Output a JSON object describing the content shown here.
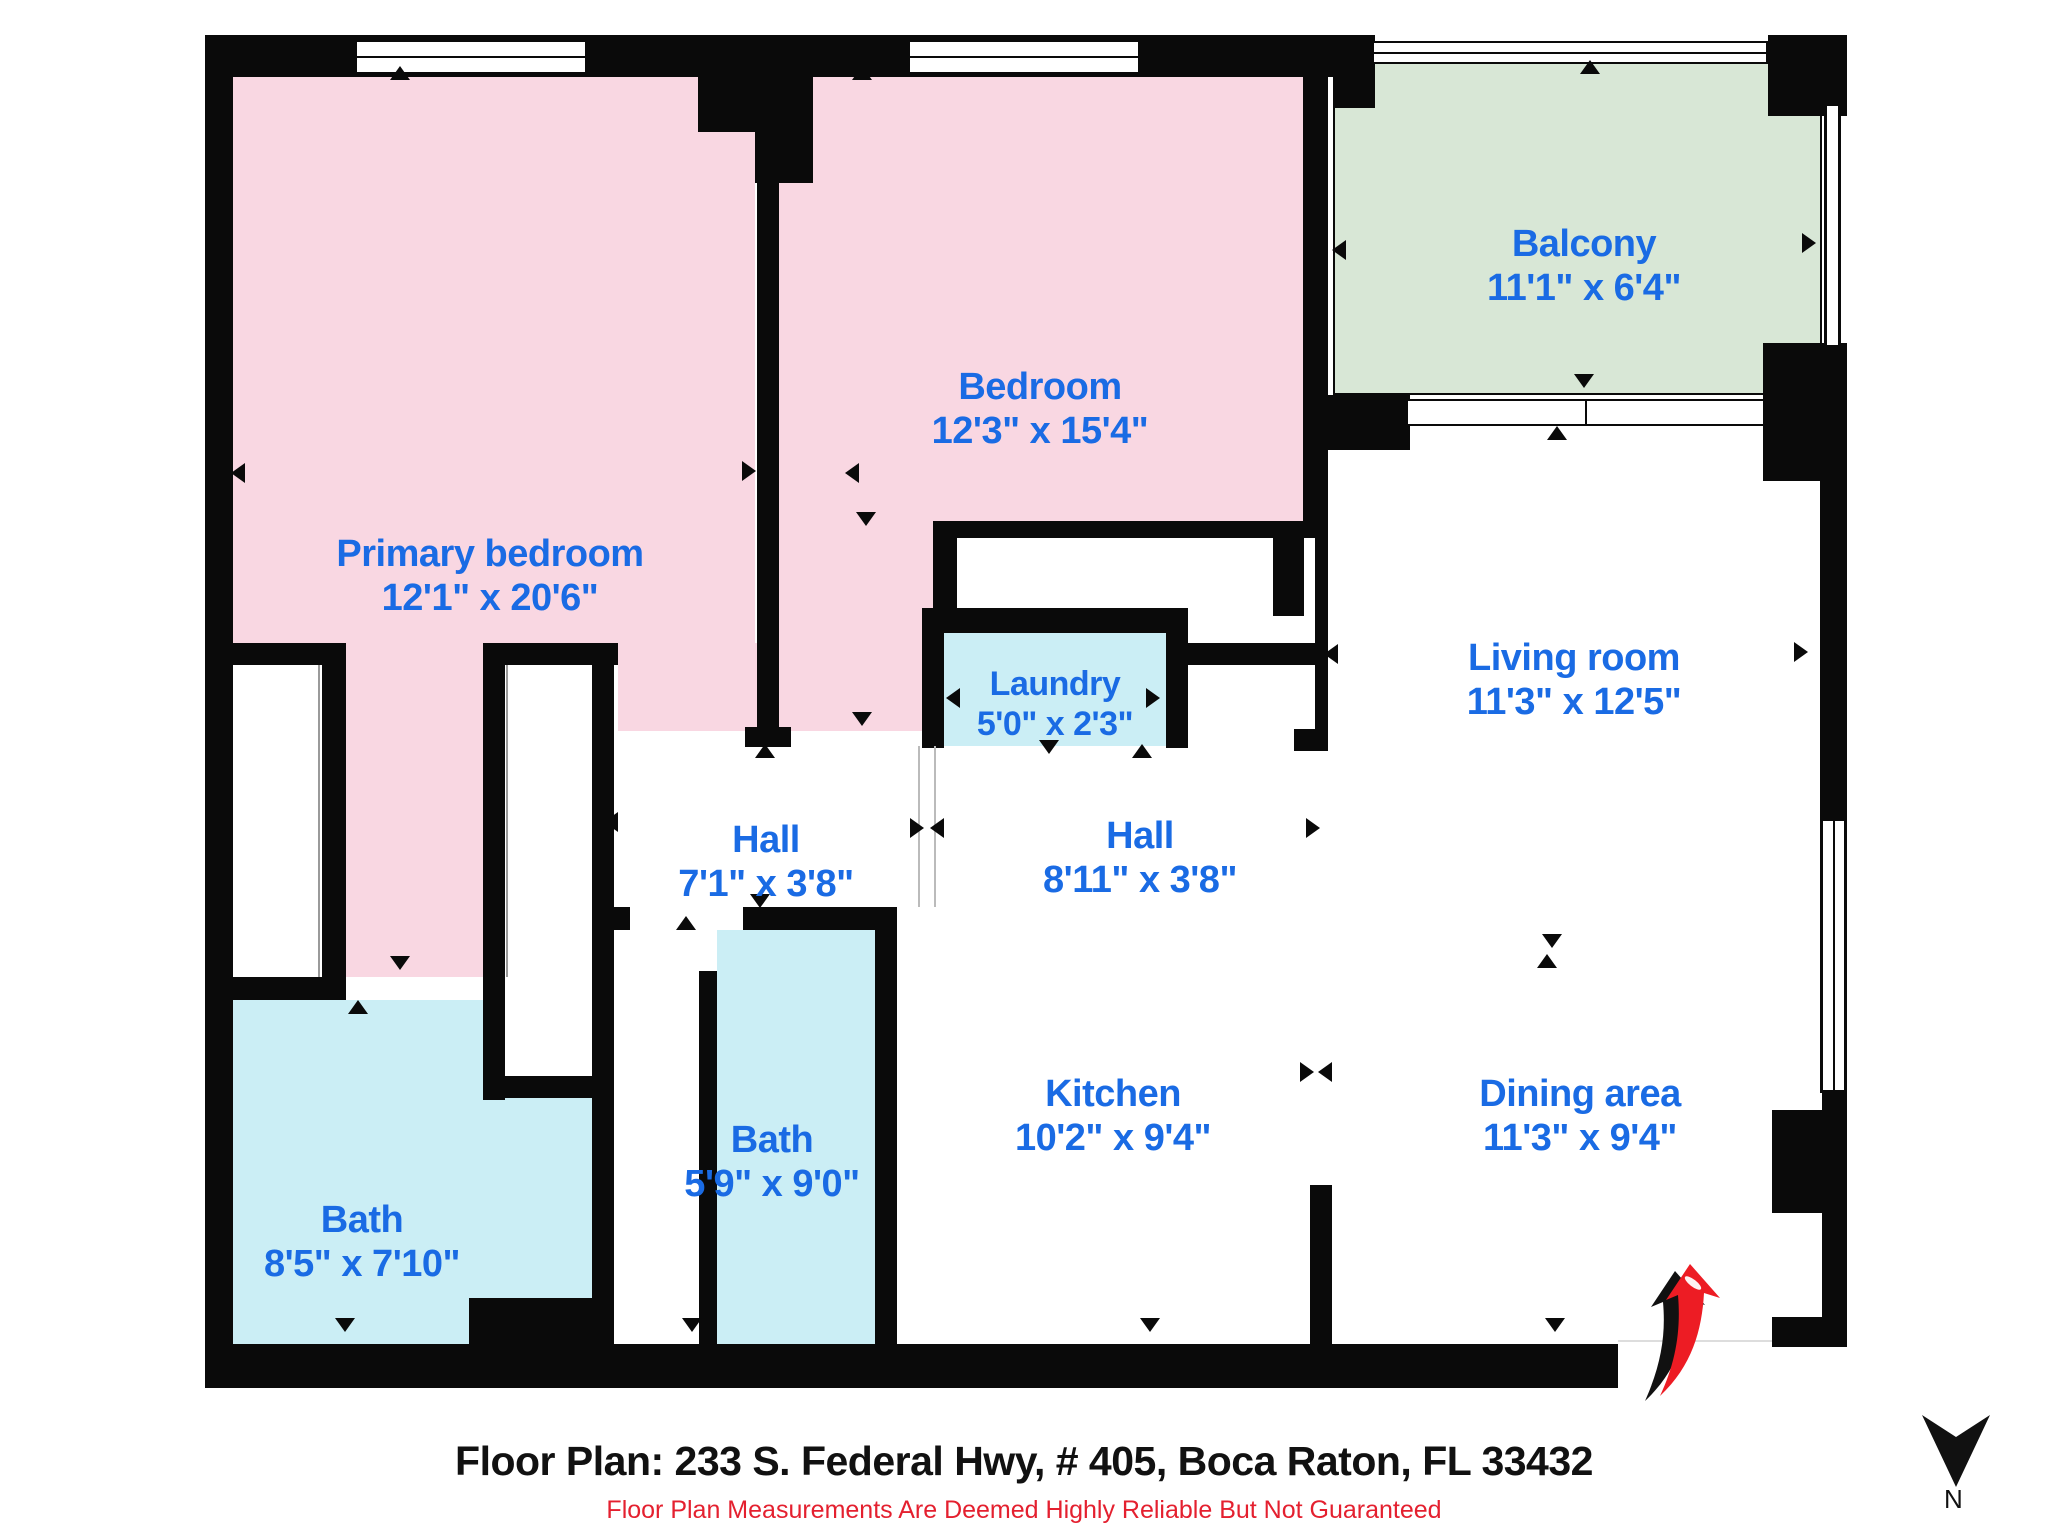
{
  "rooms": [
    {
      "id": "primary-bedroom",
      "name": "Primary bedroom",
      "dims": "12'1\" x 20'6\"",
      "floor_color": "#f9d7e2"
    },
    {
      "id": "bedroom",
      "name": "Bedroom",
      "dims": "12'3\" x 15'4\"",
      "floor_color": "#f9d7e2"
    },
    {
      "id": "balcony",
      "name": "Balcony",
      "dims": "11'1\" x 6'4\"",
      "floor_color": "#d8e7d6"
    },
    {
      "id": "laundry",
      "name": "Laundry",
      "dims": "5'0\" x 2'3\"",
      "floor_color": "#cbeef5"
    },
    {
      "id": "hall-1",
      "name": "Hall",
      "dims": "7'1\" x 3'8\"",
      "floor_color": "#ffffff"
    },
    {
      "id": "hall-2",
      "name": "Hall",
      "dims": "8'11\" x 3'8\"",
      "floor_color": "#ffffff"
    },
    {
      "id": "living-room",
      "name": "Living room",
      "dims": "11'3\" x 12'5\"",
      "floor_color": "#ffffff"
    },
    {
      "id": "bath-1",
      "name": "Bath",
      "dims": "8'5\" x 7'10\"",
      "floor_color": "#cbeef5"
    },
    {
      "id": "bath-2",
      "name": "Bath",
      "dims": "5'9\" x 9'0\"",
      "floor_color": "#cbeef5"
    },
    {
      "id": "kitchen",
      "name": "Kitchen",
      "dims": "10'2\" x 9'4\"",
      "floor_color": "#ffffff"
    },
    {
      "id": "dining-area",
      "name": "Dining area",
      "dims": "11'3\" x 9'4\"",
      "floor_color": "#ffffff"
    }
  ],
  "footer": {
    "title": "Floor Plan: 233 S. Federal Hwy, # 405, Boca Raton, FL 33432",
    "disclaimer": "Floor Plan Measurements Are Deemed Highly Reliable But Not Guaranteed"
  },
  "compass": {
    "label": "N"
  },
  "colors": {
    "label_blue": "#1a6be4",
    "disclaimer_red": "#e4202f",
    "wall_black": "#0a0a0a",
    "bedroom_pink": "#f9d7e2",
    "balcony_green": "#d8e7d6",
    "bath_cyan": "#cbeef5",
    "entry_arrow_red": "#ed1c24"
  }
}
